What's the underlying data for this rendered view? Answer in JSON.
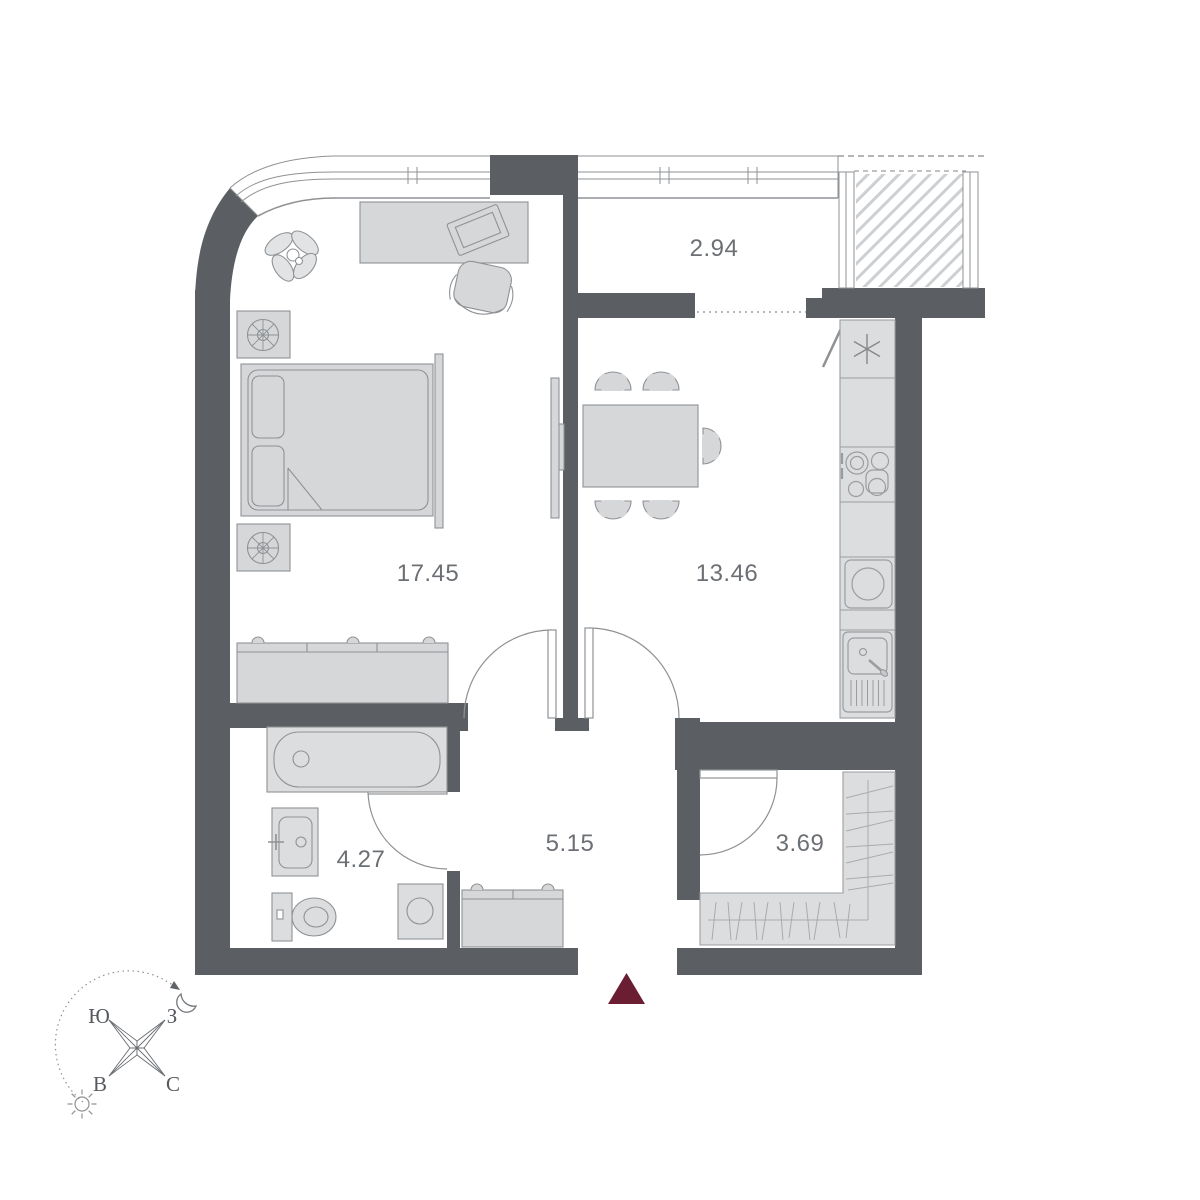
{
  "floor_plan": {
    "rooms": {
      "bedroom": {
        "area": "17.45"
      },
      "kitchen_living": {
        "area": "13.46"
      },
      "loggia": {
        "area": "2.94"
      },
      "hallway": {
        "area": "5.15"
      },
      "bathroom": {
        "area": "4.27"
      },
      "wardrobe": {
        "area": "3.69"
      }
    },
    "compass": {
      "south": "Ю",
      "west": "З",
      "east": "В",
      "north": "С"
    },
    "colors": {
      "wall": "#5b5f63",
      "furniture_fill": "#d6d7d9",
      "furniture_outline": "#8f9295",
      "thin_line": "#9a9da0",
      "hatch_line": "#cdd0d2",
      "label_text": "#6c7074",
      "entrance_marker": "#6b1e32"
    }
  }
}
